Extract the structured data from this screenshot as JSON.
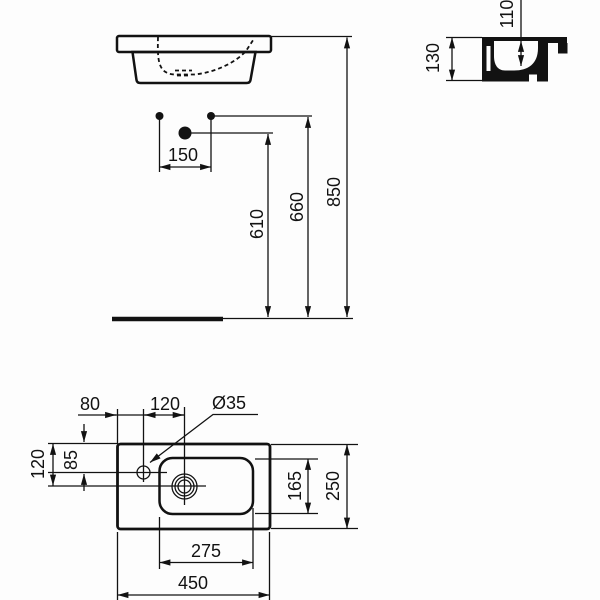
{
  "drawing_title": "washbasin-technical-drawing",
  "colors": {
    "line": "#121212",
    "background": "#fdfdfd"
  },
  "dimensions": {
    "elevation": {
      "fixing_hole_spacing": "150",
      "trap_outlet_height": "610",
      "fixing_holes_height": "660",
      "rim_height": "850"
    },
    "side": {
      "inner_depth": "110",
      "basin_height": "130"
    },
    "plan": {
      "tap_hole_from_left_edge": "80",
      "tap_hole_to_drain": "120",
      "tap_hole_diameter": "Ø35",
      "tap_hole_from_back_edge": "85",
      "drain_from_back_edge": "120",
      "bowl_depth": "165",
      "overall_depth": "250",
      "bowl_width": "275",
      "overall_width": "450"
    }
  }
}
